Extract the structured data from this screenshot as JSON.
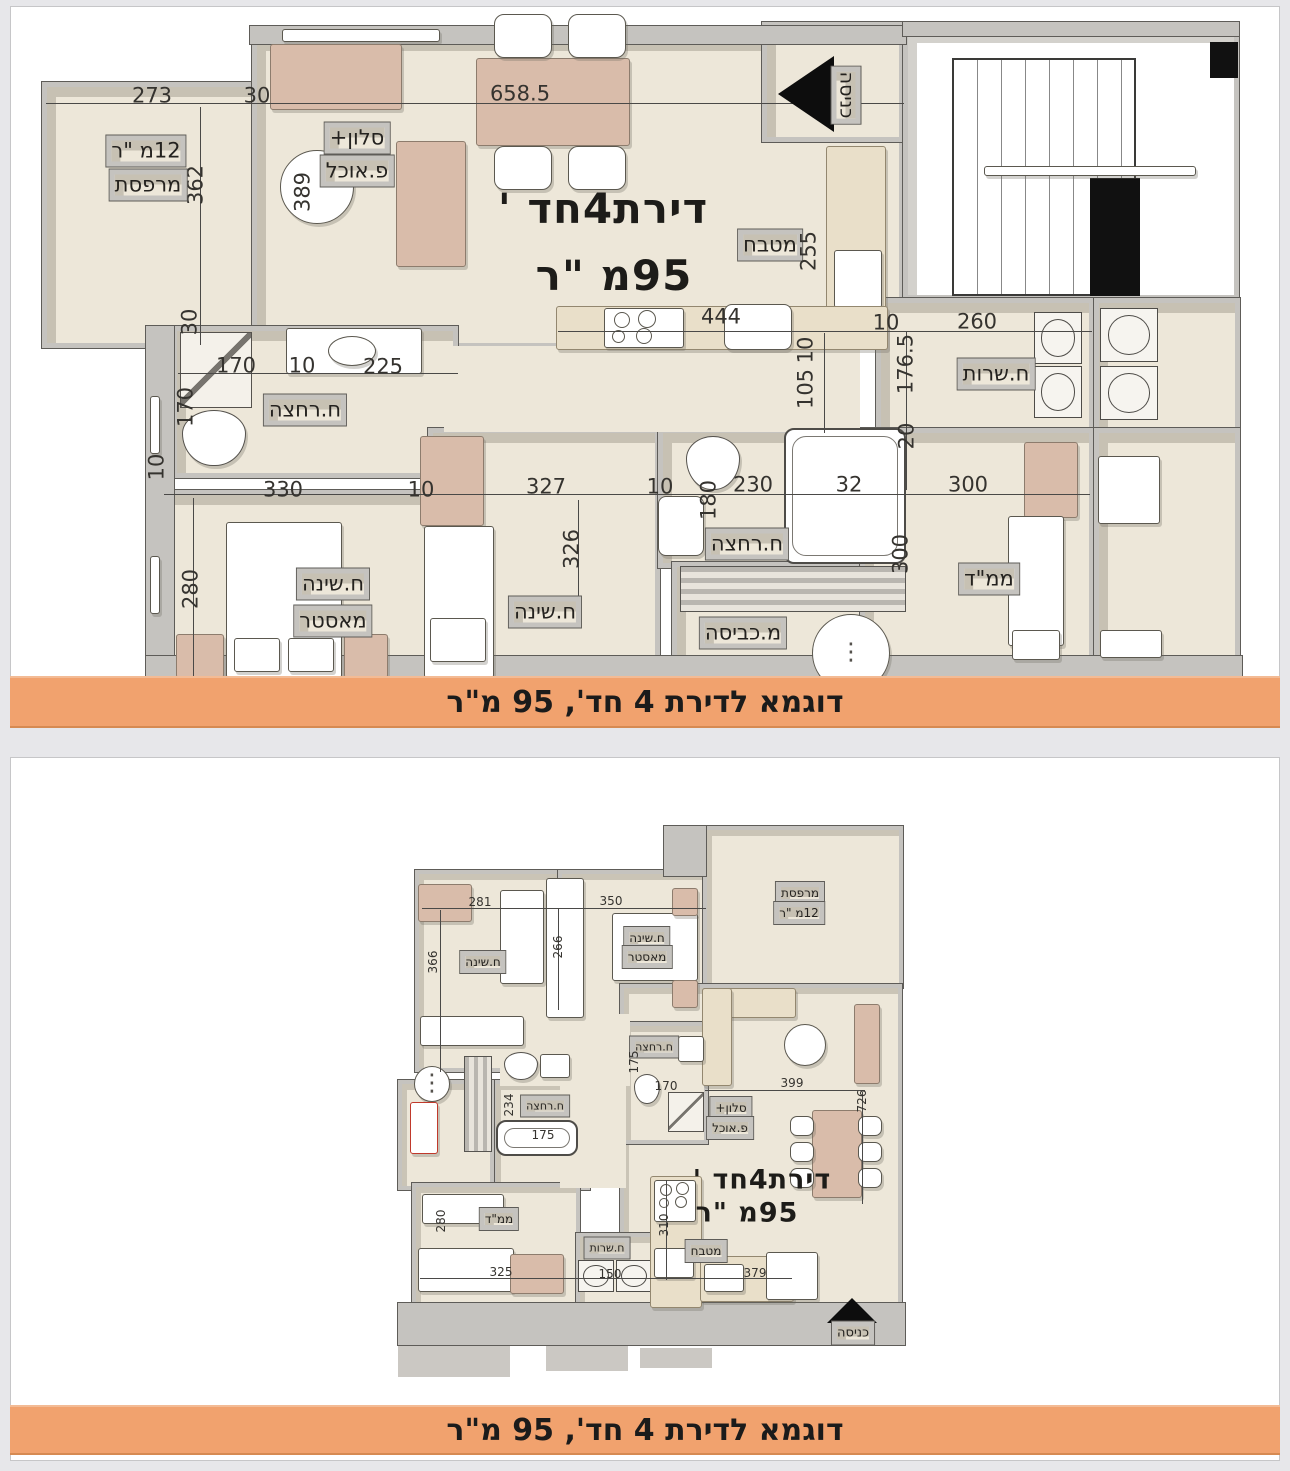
{
  "banners": {
    "top": "דוגמא לדירת 4 חד', 95 מ\"ר",
    "bottom": "דוגמא לדירת 4 חד', 95 מ\"ר"
  },
  "colors": {
    "banner": "#F1A26E",
    "floor": "#EDE7D9",
    "wall": "#C5C3BF",
    "tan": "#D9BCAA",
    "cream": "#E9DFC9"
  },
  "plan_top": {
    "labels": [
      {
        "t": "273",
        "x": 152,
        "y": 96,
        "k": "dim"
      },
      {
        "t": "30",
        "x": 257,
        "y": 96,
        "k": "dim"
      },
      {
        "t": "658.5",
        "x": 520,
        "y": 94,
        "k": "dim"
      },
      {
        "t": "362",
        "x": 196,
        "y": 185,
        "k": "dim",
        "v": 1
      },
      {
        "t": "389",
        "x": 303,
        "y": 192,
        "k": "dim",
        "v": 1
      },
      {
        "t": "סלון+",
        "x": 357,
        "y": 138,
        "k": "room"
      },
      {
        "t": "פ.אוכל",
        "x": 357,
        "y": 171,
        "k": "room"
      },
      {
        "t": "12מ \"ר",
        "x": 146,
        "y": 151,
        "k": "room"
      },
      {
        "t": "מרפסת",
        "x": 148,
        "y": 185,
        "k": "room"
      },
      {
        "t": "כניסה",
        "x": 846,
        "y": 95,
        "k": "room",
        "r": 90,
        "fs": 19
      },
      {
        "t": "מטבח",
        "x": 770,
        "y": 245,
        "k": "room"
      },
      {
        "t": "255",
        "x": 809,
        "y": 251,
        "k": "dim",
        "v": 1
      },
      {
        "t": "444",
        "x": 721,
        "y": 317,
        "k": "dim"
      },
      {
        "t": "10",
        "x": 806,
        "y": 350,
        "k": "dim",
        "v": 1
      },
      {
        "t": "105",
        "x": 806,
        "y": 389,
        "k": "dim",
        "v": 1
      },
      {
        "t": "10",
        "x": 886,
        "y": 323,
        "k": "dim"
      },
      {
        "t": "260",
        "x": 977,
        "y": 322,
        "k": "dim"
      },
      {
        "t": "176.5",
        "x": 906,
        "y": 364,
        "k": "dim",
        "v": 1
      },
      {
        "t": "ח.שרות",
        "x": 996,
        "y": 374,
        "k": "room"
      },
      {
        "t": "20",
        "x": 907,
        "y": 436,
        "k": "dim",
        "v": 1
      },
      {
        "t": "170",
        "x": 236,
        "y": 366,
        "k": "dim"
      },
      {
        "t": "10",
        "x": 302,
        "y": 366,
        "k": "dim"
      },
      {
        "t": "225",
        "x": 383,
        "y": 367,
        "k": "dim"
      },
      {
        "t": "ח.רחצה",
        "x": 305,
        "y": 410,
        "k": "room"
      },
      {
        "t": "170",
        "x": 186,
        "y": 407,
        "k": "dim",
        "v": 1
      },
      {
        "t": "30",
        "x": 190,
        "y": 322,
        "k": "dim",
        "v": 1
      },
      {
        "t": "10",
        "x": 157,
        "y": 467,
        "k": "dim",
        "v": 1
      },
      {
        "t": "330",
        "x": 283,
        "y": 490,
        "k": "dim"
      },
      {
        "t": "10",
        "x": 421,
        "y": 490,
        "k": "dim"
      },
      {
        "t": "327",
        "x": 546,
        "y": 487,
        "k": "dim"
      },
      {
        "t": "10",
        "x": 660,
        "y": 487,
        "k": "dim"
      },
      {
        "t": "230",
        "x": 753,
        "y": 485,
        "k": "dim"
      },
      {
        "t": "32",
        "x": 849,
        "y": 485,
        "k": "dim"
      },
      {
        "t": "300",
        "x": 968,
        "y": 485,
        "k": "dim"
      },
      {
        "t": "280",
        "x": 191,
        "y": 589,
        "k": "dim",
        "v": 1
      },
      {
        "t": "ח.שינה",
        "x": 333,
        "y": 584,
        "k": "room"
      },
      {
        "t": "מאסטר",
        "x": 333,
        "y": 621,
        "k": "room"
      },
      {
        "t": "326",
        "x": 572,
        "y": 549,
        "k": "dim",
        "v": 1
      },
      {
        "t": "ח.שינה",
        "x": 545,
        "y": 612,
        "k": "room"
      },
      {
        "t": "180",
        "x": 709,
        "y": 500,
        "k": "dim",
        "v": 1
      },
      {
        "t": "ח.רחצה",
        "x": 747,
        "y": 544,
        "k": "room"
      },
      {
        "t": "מ.כביסה",
        "x": 743,
        "y": 633,
        "k": "room"
      },
      {
        "t": "ממ\"ד",
        "x": 989,
        "y": 579,
        "k": "room"
      },
      {
        "t": "300",
        "x": 901,
        "y": 554,
        "k": "dim",
        "v": 1
      },
      {
        "t": "דירת4חד '",
        "x": 603,
        "y": 209,
        "k": "title"
      },
      {
        "t": "95מ \"ר",
        "x": 614,
        "y": 276,
        "k": "title"
      }
    ]
  },
  "plan_bottom": {
    "labels": [
      {
        "t": "281",
        "x": 480,
        "y": 902,
        "k": "dim"
      },
      {
        "t": "350",
        "x": 611,
        "y": 901,
        "k": "dim"
      },
      {
        "t": "366",
        "x": 433,
        "y": 962,
        "k": "dim",
        "v": 1
      },
      {
        "t": "266",
        "x": 558,
        "y": 947,
        "k": "dim",
        "v": 1
      },
      {
        "t": "ח.שינה",
        "x": 483,
        "y": 962,
        "k": "room"
      },
      {
        "t": "ח.שינה",
        "x": 647,
        "y": 938,
        "k": "room"
      },
      {
        "t": "מאסטר",
        "x": 647,
        "y": 957,
        "k": "room"
      },
      {
        "t": "מרפסת",
        "x": 800,
        "y": 893,
        "k": "room"
      },
      {
        "t": "12מ \"ר",
        "x": 799,
        "y": 913,
        "k": "room"
      },
      {
        "t": "ח.רחצה",
        "x": 654,
        "y": 1047,
        "k": "room",
        "fs": 11
      },
      {
        "t": "175",
        "x": 634,
        "y": 1062,
        "k": "dim",
        "v": 1
      },
      {
        "t": "170",
        "x": 666,
        "y": 1086,
        "k": "dim"
      },
      {
        "t": "399",
        "x": 792,
        "y": 1083,
        "k": "dim"
      },
      {
        "t": "726",
        "x": 862,
        "y": 1101,
        "k": "dim",
        "v": 1
      },
      {
        "t": "סלון+",
        "x": 731,
        "y": 1108,
        "k": "room"
      },
      {
        "t": "פ.אוכל",
        "x": 730,
        "y": 1128,
        "k": "room"
      },
      {
        "t": "234",
        "x": 509,
        "y": 1105,
        "k": "dim",
        "v": 1
      },
      {
        "t": "ח.רחצה",
        "x": 545,
        "y": 1106,
        "k": "room",
        "fs": 11
      },
      {
        "t": "175",
        "x": 543,
        "y": 1135,
        "k": "dim"
      },
      {
        "t": "ממ\"ד",
        "x": 499,
        "y": 1219,
        "k": "room"
      },
      {
        "t": "280",
        "x": 441,
        "y": 1221,
        "k": "dim",
        "v": 1
      },
      {
        "t": "325",
        "x": 501,
        "y": 1272,
        "k": "dim"
      },
      {
        "t": "ח.שרות",
        "x": 607,
        "y": 1248,
        "k": "room",
        "fs": 11
      },
      {
        "t": "150",
        "x": 610,
        "y": 1274,
        "k": "dim"
      },
      {
        "t": "מטבח",
        "x": 706,
        "y": 1251,
        "k": "room"
      },
      {
        "t": "310",
        "x": 664,
        "y": 1225,
        "k": "dim",
        "v": 1
      },
      {
        "t": "379",
        "x": 755,
        "y": 1273,
        "k": "dim"
      },
      {
        "t": "דירת4חד '",
        "x": 762,
        "y": 1180,
        "k": "title"
      },
      {
        "t": "95מ \"ר",
        "x": 747,
        "y": 1213,
        "k": "title"
      },
      {
        "t": "כניסה",
        "x": 853,
        "y": 1333,
        "k": "room",
        "fs": 13
      }
    ]
  }
}
